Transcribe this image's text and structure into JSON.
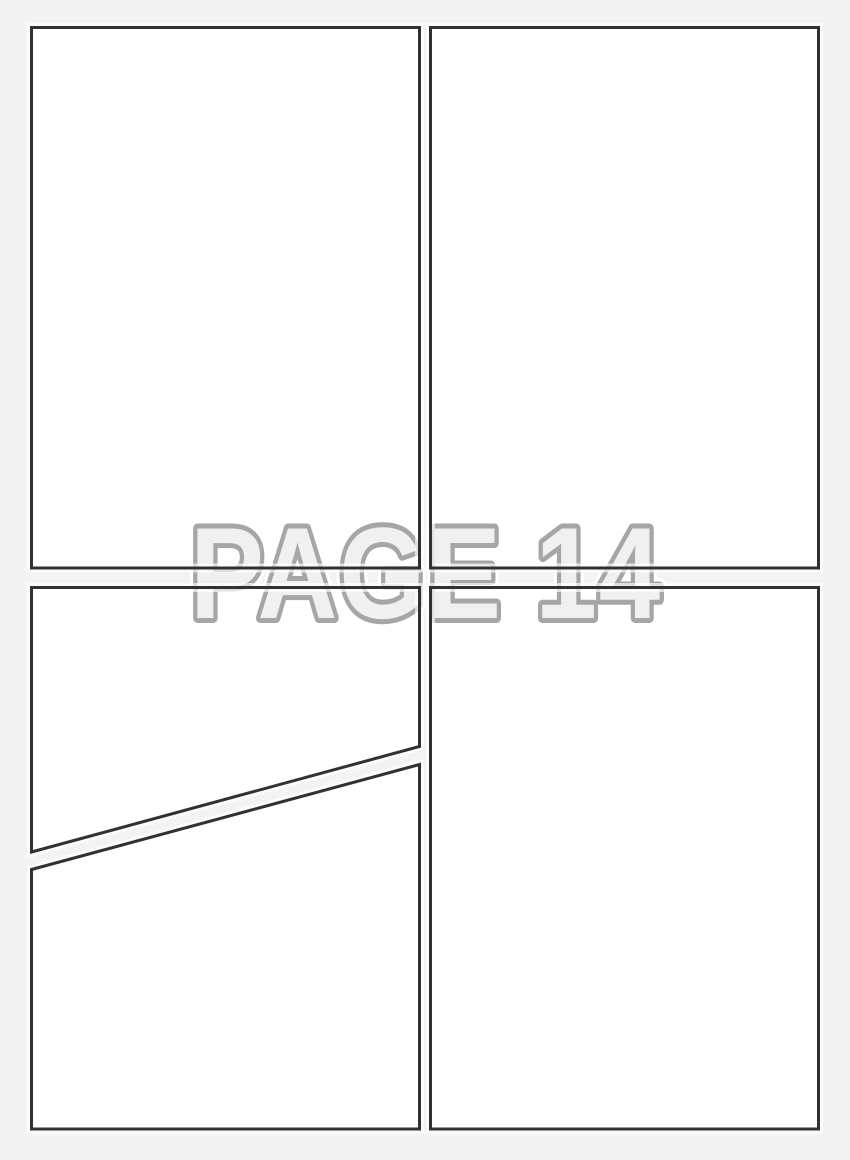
{
  "watermark": {
    "text": "PAGE 14"
  },
  "colors": {
    "background": "#f3f3f4",
    "panel_fill": "#ffffff",
    "panel_border": "#313131",
    "gutter_highlight": "#ffffff",
    "watermark_fill": "#f0f0f1",
    "watermark_outline": "#a6a6a6",
    "watermark_halo": "#ffffff"
  },
  "panels": [
    {
      "id": "panel-1",
      "position": "top-left",
      "shape": "rectangle"
    },
    {
      "id": "panel-2",
      "position": "top-right",
      "shape": "rectangle"
    },
    {
      "id": "panel-3",
      "position": "middle-left",
      "shape": "trapezoid-diagonal-bottom"
    },
    {
      "id": "panel-4",
      "position": "bottom-left",
      "shape": "trapezoid-diagonal-top"
    },
    {
      "id": "panel-5",
      "position": "bottom-right",
      "shape": "rectangle"
    }
  ]
}
